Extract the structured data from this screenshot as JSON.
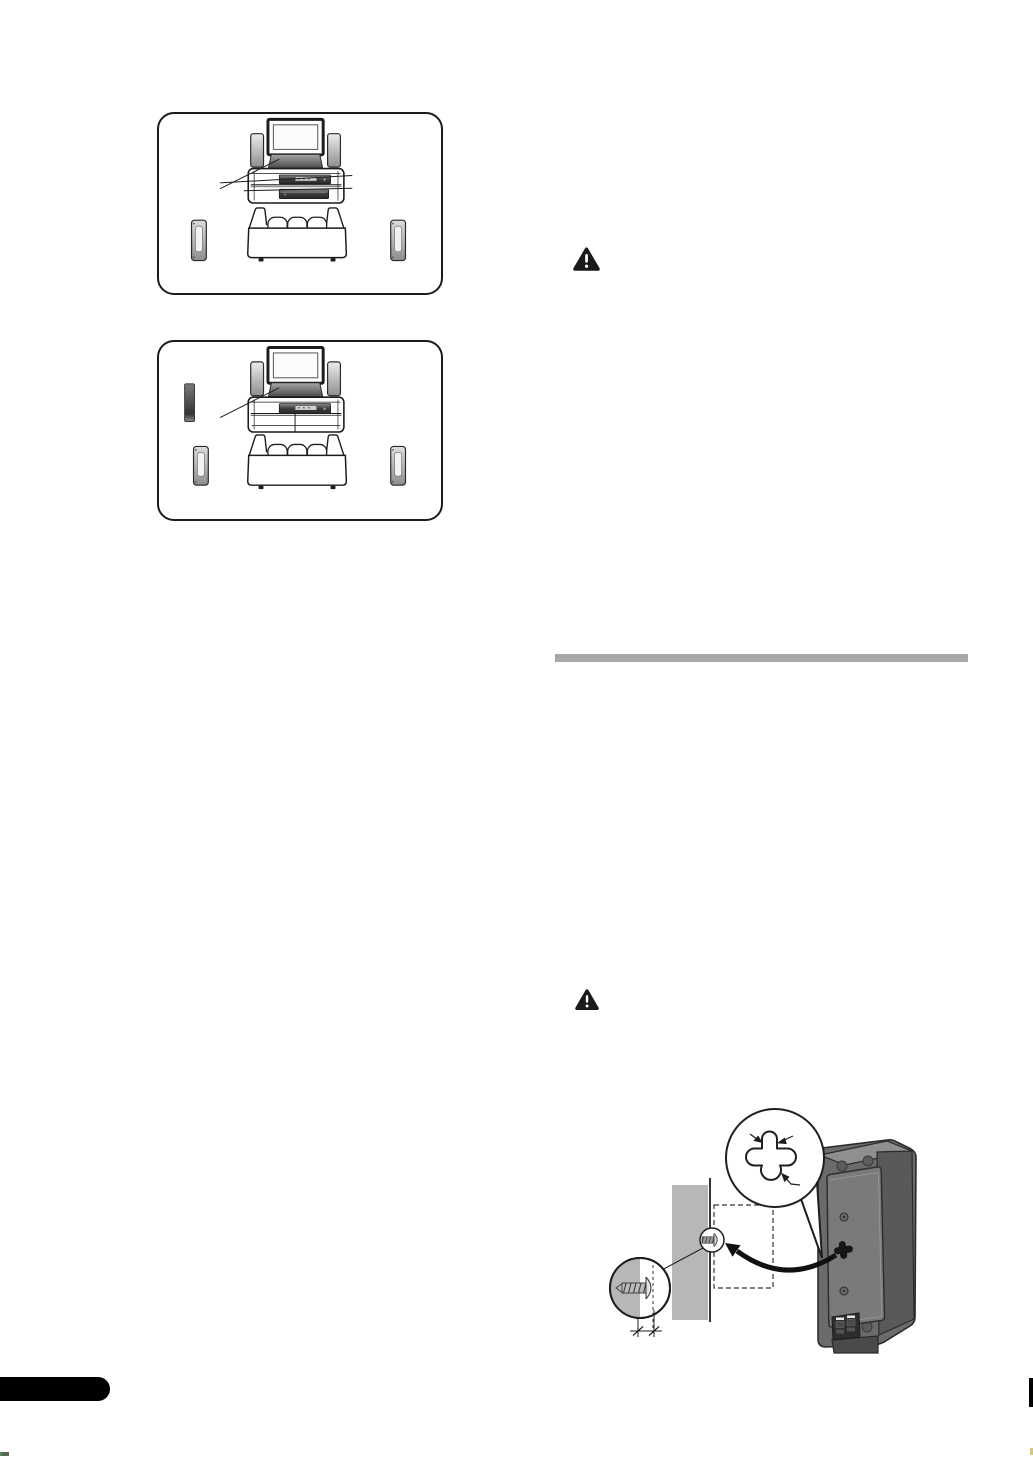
{
  "page": {
    "width_px": 1033,
    "height_px": 1458,
    "background_color": "#ffffff"
  },
  "colors": {
    "outline": "#1c1c1c",
    "warning_black": "#1a1a1a",
    "divider_gray": "#a8a8a8",
    "wall_gray": "#b7b7b7",
    "speaker_back_face": "#6b6b6b",
    "speaker_side_face": "#595959",
    "speaker_top_face": "#8f8f8f",
    "speaker_panel": "#7a7a7a",
    "device_dark": "#3c3c3c",
    "footer_tab_black": "#000000"
  },
  "icons": {
    "warning_upper": "warning-triangle-icon",
    "warning_lower": "warning-triangle-icon"
  },
  "figures": {
    "placement_diagram_top": {
      "icon": "home-theater-room-layout-illustration",
      "elements": [
        "tv",
        "front-tower-speakers",
        "center-speaker",
        "receiver-unit",
        "player-unit",
        "callout-leader-lines",
        "sofa",
        "left-surround-speaker",
        "right-surround-speaker"
      ]
    },
    "placement_diagram_bottom": {
      "icon": "home-theater-room-layout-illustration-with-wall-speaker",
      "elements": [
        "tv",
        "front-tower-speakers",
        "center-speaker",
        "receiver-unit",
        "callout-leader-lines",
        "wall-mounted-speaker",
        "sofa",
        "left-surround-speaker",
        "right-surround-speaker"
      ]
    },
    "wall_mount_diagram": {
      "icon": "speaker-wall-mounting-illustration",
      "elements": [
        "keyhole-slot-detail-callout",
        "wall",
        "screw-in-wall-marker",
        "screw-protrusion-detail-callout",
        "mounting-position-dashed-outline",
        "hanging-direction-arrow",
        "speaker-rear-view",
        "screw-gap-dimension-marks"
      ]
    }
  },
  "divider": {
    "style": "solid-gray-section-bar"
  },
  "footer": {
    "tab_style": "black-rounded-tab",
    "edge_mark_style": "black-edge-index-bar"
  }
}
